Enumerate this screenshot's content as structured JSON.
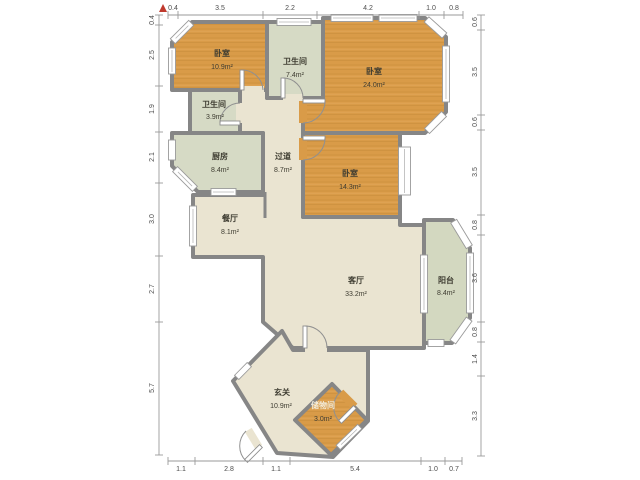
{
  "plan_title": "户型图",
  "north_indicator": "N",
  "rooms": [
    {
      "id": "bedroom-1",
      "name": "卧室",
      "area": "10.9m²"
    },
    {
      "id": "bath-1",
      "name": "卫生间",
      "area": "7.4m²"
    },
    {
      "id": "bedroom-2",
      "name": "卧室",
      "area": "24.0m²"
    },
    {
      "id": "bath-2",
      "name": "卫生间",
      "area": "3.9m²"
    },
    {
      "id": "kitchen",
      "name": "厨房",
      "area": "8.4m²"
    },
    {
      "id": "hallway",
      "name": "过道",
      "area": "8.7m²"
    },
    {
      "id": "bedroom-3",
      "name": "卧室",
      "area": "14.3m²"
    },
    {
      "id": "dining",
      "name": "餐厅",
      "area": "8.1m²"
    },
    {
      "id": "living",
      "name": "客厅",
      "area": "33.2m²"
    },
    {
      "id": "balcony",
      "name": "阳台",
      "area": "8.4m²"
    },
    {
      "id": "entry",
      "name": "玄关",
      "area": "10.9m²"
    },
    {
      "id": "storage",
      "name": "储物间",
      "area": "3.0m²"
    }
  ],
  "dimensions": {
    "top": [
      "0.4",
      "3.5",
      "2.2",
      "4.2",
      "1.0",
      "0.8"
    ],
    "left": [
      "0.4",
      "2.5",
      "1.9",
      "2.1",
      "3.0",
      "2.7",
      "5.7"
    ],
    "right": [
      "0.6",
      "3.5",
      "0.6",
      "3.5",
      "0.8",
      "3.6",
      "0.8",
      "1.4",
      "3.3"
    ],
    "bottom": [
      "1.1",
      "2.8",
      "1.1",
      "5.4",
      "1.0",
      "0.7"
    ]
  },
  "colors": {
    "wall": "#868686",
    "wood_floor": "#d99b48",
    "tile_floor": "#d6dac5",
    "main_floor": "#eae4d1",
    "north_arrow": "#c03a2e"
  }
}
